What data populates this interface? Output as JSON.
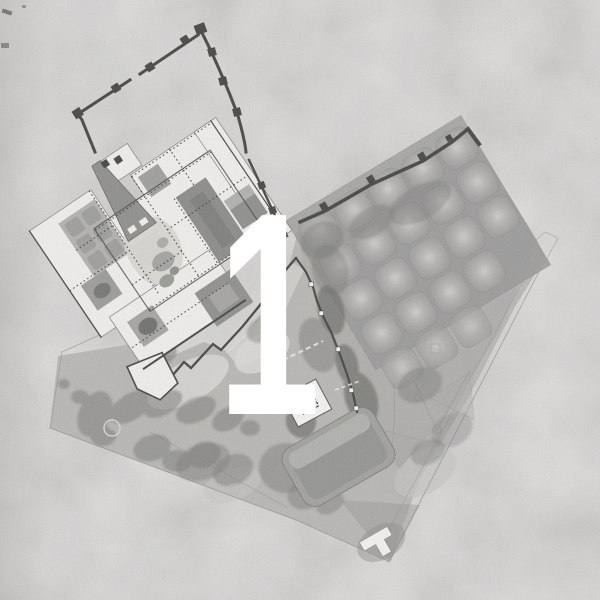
{
  "figure": {
    "type": "architectural site plan",
    "overlay_label": "1",
    "style": "grayscale masterplan drawing on textured paper"
  },
  "palette": {
    "paper": "#dbdad8",
    "terrain": "#b4b3b1",
    "canopy": "#7d7d7b",
    "orchard": "#9b9a98",
    "palace": "#efeeec",
    "wall": "#454543",
    "court": "#8b8b89",
    "outline": "#8f8f8d",
    "numeral": "#ffffff"
  },
  "features": [
    "fortified perimeter wall with towers",
    "palace floor plan with courtyards",
    "tapering tower",
    "pond garden",
    "pointed bastion",
    "orchard plot grid",
    "tree canopy masses",
    "garden paths and parterres",
    "square pavilion with inner courtyard",
    "terraced platform",
    "building at southern tip"
  ]
}
